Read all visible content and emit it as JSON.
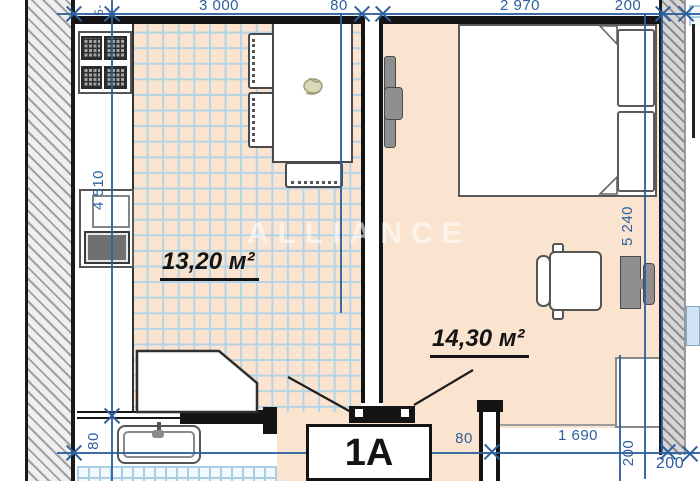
{
  "watermark": "ALLIANCE",
  "rooms": {
    "kitchen": {
      "area_label": "13,20 м²"
    },
    "bedroom": {
      "area_label": "14,30 м²"
    }
  },
  "unit": {
    "label": "1A"
  },
  "dimensions": {
    "top": {
      "edge_fragment": "5-",
      "kitchen_width": "3 000",
      "partition": "80",
      "bedroom_width": "2 970",
      "wall": "200"
    },
    "left": {
      "kitchen_depth": "4 510",
      "bath_offset": "80"
    },
    "right": {
      "bedroom_depth": "5 240"
    },
    "bottom": {
      "door_offset": "80",
      "segment": "1 690",
      "shaft": "200",
      "wall": "200"
    }
  },
  "colors": {
    "dimension_blue": "#2d5f9e",
    "floor_peach": "#fae3cf",
    "tile_blue": "#b3d4e6",
    "wall_black": "#141414"
  }
}
